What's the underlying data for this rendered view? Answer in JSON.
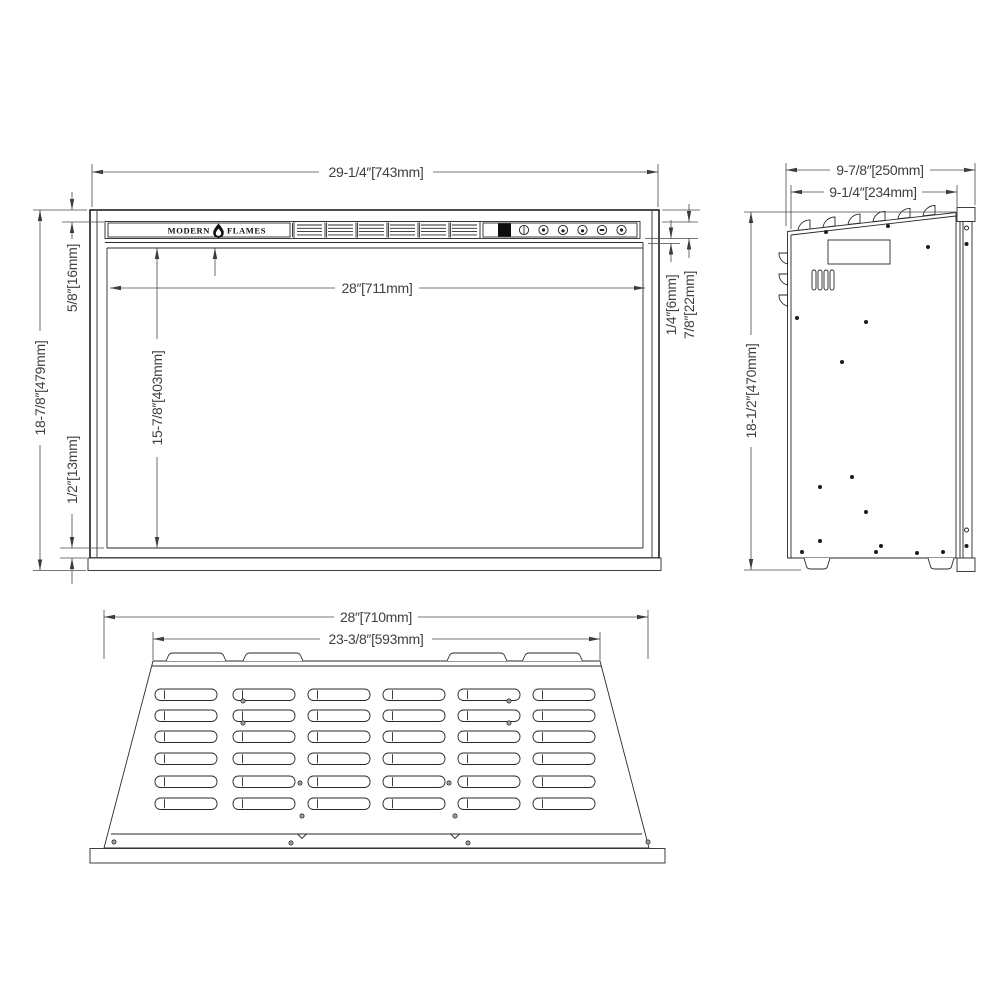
{
  "brand": {
    "left": "MODERN",
    "right": "FLAMES"
  },
  "front_view": {
    "dims": {
      "overall_width": "29-1/4″[743mm]",
      "overall_height": "18-7/8″[479mm]",
      "top_frame": "5/8″[16mm]",
      "bottom_frame": "1/2″[13mm]",
      "glass_width": "28″[711mm]",
      "glass_height": "15-7/8″[403mm]",
      "trim_gap": "1/4″[6mm]",
      "control_bar_height": "7/8″[22mm]"
    }
  },
  "side_view": {
    "dims": {
      "overall_depth": "9-7/8″[250mm]",
      "body_depth": "9-1/4″[234mm]",
      "overall_height": "18-1/2″[470mm]"
    }
  },
  "top_view": {
    "dims": {
      "overall_width": "28″[710mm]",
      "vent_width": "23-3/8″[593mm]"
    }
  }
}
